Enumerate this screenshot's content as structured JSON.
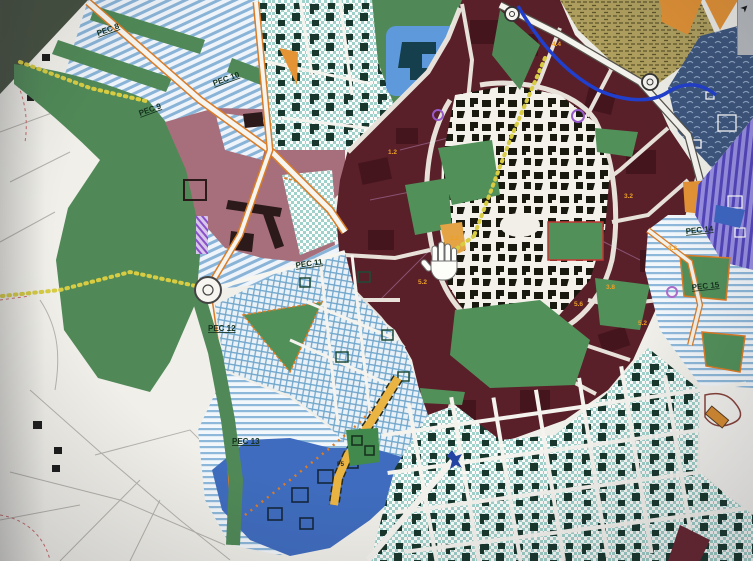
{
  "window": {
    "corner_control": {
      "glyph": "➤",
      "name": "panel-collapse-arrow"
    }
  },
  "map": {
    "type": "urban-zoning-plan",
    "cursor": {
      "type": "hand-pan-cursor"
    },
    "pec_labels": [
      {
        "text": "PEC 8"
      },
      {
        "text": "PEC 9"
      },
      {
        "text": "PEC 10"
      },
      {
        "text": "PEC 11"
      },
      {
        "text": "PEC 12"
      },
      {
        "text": "PEC 13"
      },
      {
        "text": "PEC 14"
      },
      {
        "text": "PEC 15"
      }
    ],
    "zone_density_labels": [
      "1.2",
      "4.4",
      "3.2",
      "3.2",
      "3.8",
      "5.2",
      "5.6",
      "2.2",
      "5.2"
    ],
    "road_labels": [
      {
        "text": "F5"
      }
    ],
    "palette": {
      "historic_ring_maroon": "#5c1f29",
      "mixed_urban_mauve": "#a96e7b",
      "green_areas": "#4d8a55",
      "development_stripe_blue": "#88b4da",
      "existing_town_checker": "#9fd2cb",
      "river_blue": "#1f3fd6",
      "special_zone_blue": "#3c6cc4",
      "services_orange": "#e8922e",
      "density_label_orange": "#f0a020",
      "navy_hatch_zone": "#3c5680",
      "violet_stripe_zone": "#5a4fc8",
      "olive_hatch_zone": "#b3a25c",
      "road_edge_orange": "#e07b20",
      "path_dots_yellow": "#d8cc3a"
    }
  }
}
